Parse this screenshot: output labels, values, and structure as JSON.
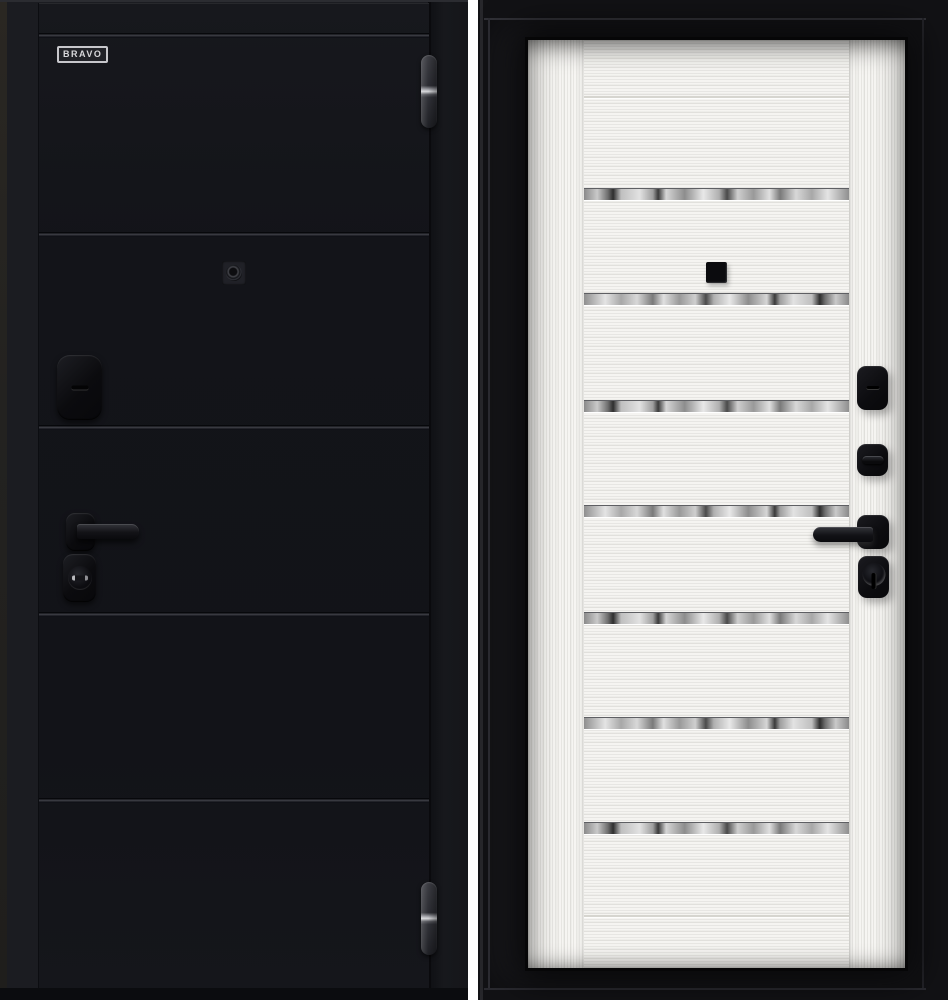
{
  "page": {
    "type": "product-photo",
    "subject": "steel entry door shown from both sides"
  },
  "brand": {
    "label": "BRAVO"
  },
  "palette": {
    "exterior_leaf": "#15161b",
    "exterior_frame": "#1b1c21",
    "interior_frame": "#161619",
    "interior_leaf": "#f5f4f1",
    "hardware_black": "#0e0e11",
    "mirror_strip_gray": "#b9b9b9",
    "divider_white": "#ffffff"
  },
  "exterior_side": {
    "finish": "black",
    "horizontal_groove_count": 5,
    "hardware_icons": [
      "barrel-hinge-icon",
      "peephole-icon",
      "lock-escutcheon-icon",
      "lever-handle-icon",
      "key-cylinder-icon"
    ]
  },
  "interior_side": {
    "finish": "white",
    "mirror_strip_count": 7,
    "hardware_icons": [
      "peephole-icon",
      "night-latch-icon",
      "thumbturn-icon",
      "lever-handle-icon",
      "key-cylinder-icon"
    ]
  }
}
